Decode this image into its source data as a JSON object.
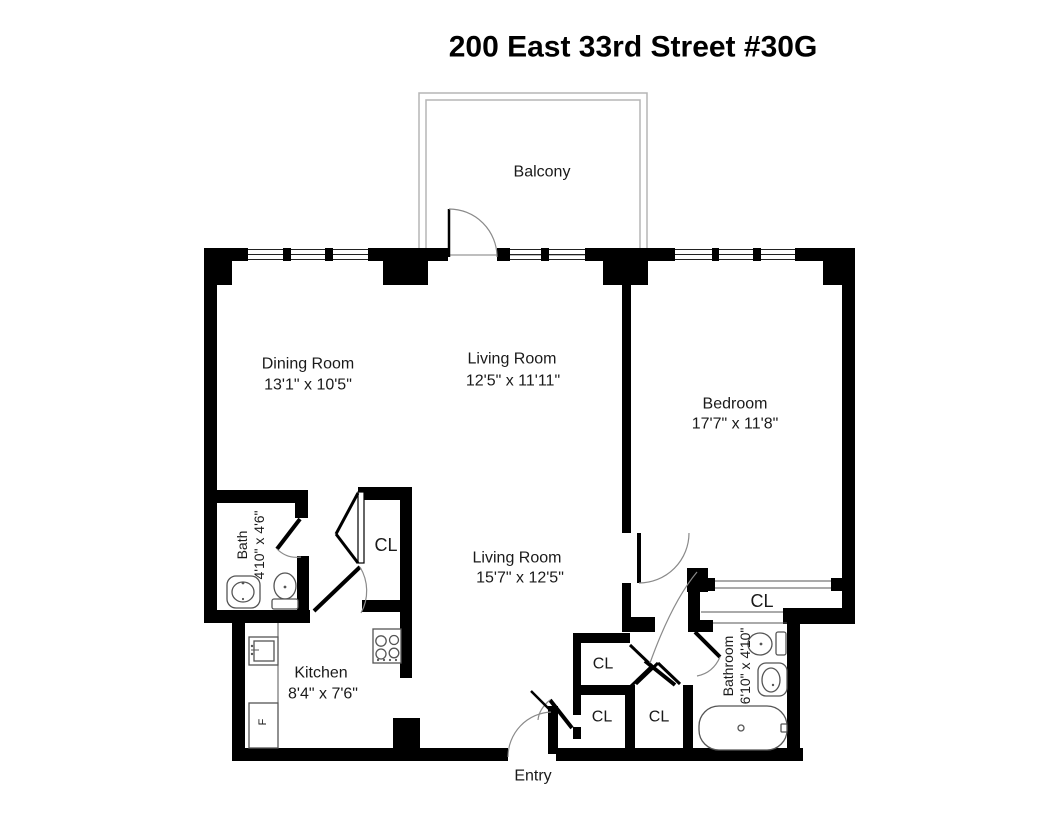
{
  "title": "200 East 33rd Street #30G",
  "rooms": {
    "balcony": {
      "label": "Balcony"
    },
    "dining_room": {
      "label": "Dining Room",
      "dims": "13'1\" x 10'5\""
    },
    "living_room_upper": {
      "label": "Living Room",
      "dims": "12'5\" x 11'11\""
    },
    "bedroom": {
      "label": "Bedroom",
      "dims": "17'7\" x 11'8\""
    },
    "living_room_lower": {
      "label": "Living Room",
      "dims": "15'7\" x 12'5\""
    },
    "bath": {
      "label": "Bath",
      "dims": "4'10\" x 4'6\""
    },
    "kitchen": {
      "label": "Kitchen",
      "dims": "8'4\" x 7'6\""
    },
    "bathroom": {
      "label": "Bathroom",
      "dims": "6'10\" x 4'10\""
    },
    "entry": {
      "label": "Entry"
    }
  },
  "closets": {
    "living_room_closet": {
      "label": "CL"
    },
    "hall_closet_upper": {
      "label": "CL"
    },
    "entry_closet_left": {
      "label": "CL"
    },
    "entry_closet_right": {
      "label": "CL"
    },
    "bedroom_closet": {
      "label": "CL"
    }
  },
  "appliances": {
    "refrigerator": {
      "label": "F"
    }
  },
  "colors": {
    "walls": "#000000",
    "background": "#ffffff",
    "fixture_line": "#555555",
    "door_arc": "#8a8a8a",
    "balcony_line": "#b5b5b5"
  }
}
